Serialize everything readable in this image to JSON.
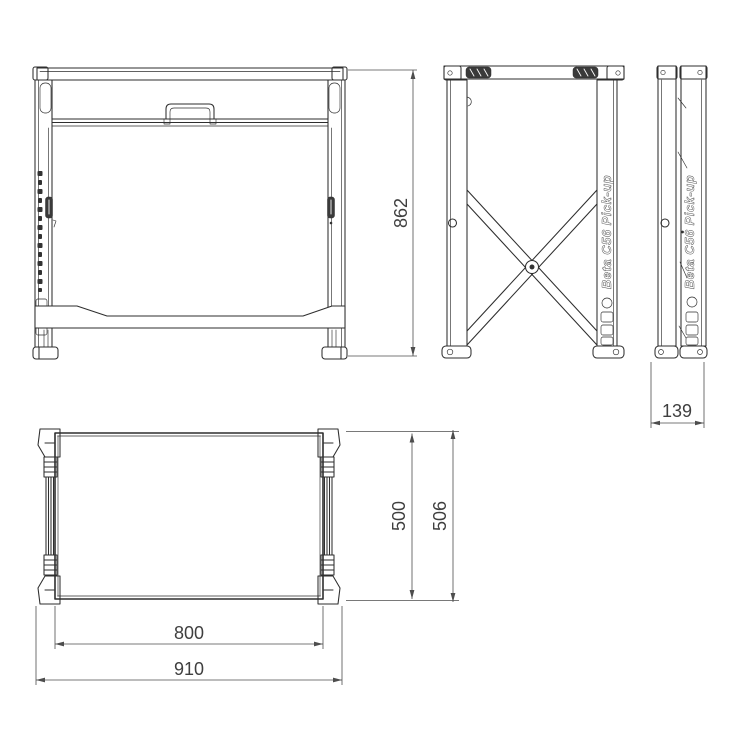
{
  "branding": {
    "side_text": "Beta C56 Pick-up"
  },
  "dimensions": {
    "front_height": "862",
    "folded_depth": "139",
    "top_depth_inner": "500",
    "top_depth_outer": "506",
    "top_width_inner": "800",
    "top_width_outer": "910"
  },
  "colors": {
    "background": "#ffffff",
    "line": "#2e2e2e",
    "dimension": "#4d4d4d"
  }
}
